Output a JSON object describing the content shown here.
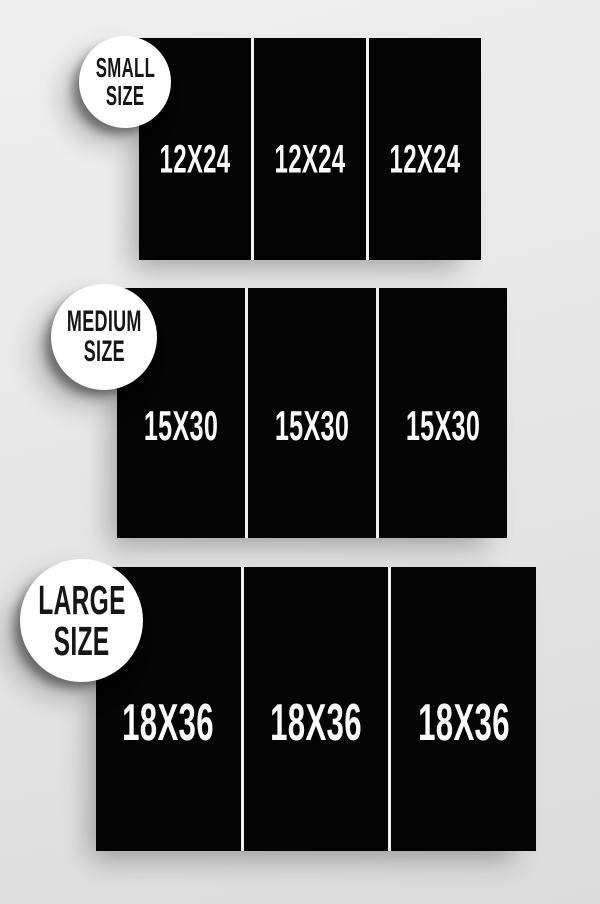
{
  "title": "Poster size chart",
  "colors": {
    "panel_bg": "#040404",
    "panel_text": "#fbfbfb",
    "divider": "#f2f2f2",
    "badge_bg": "#ffffff",
    "badge_text": "#161616",
    "page_bg_top": "#efefef",
    "page_bg_bottom": "#dbdbdb"
  },
  "groups": [
    {
      "id": "small",
      "badge": {
        "line1": "SMALL",
        "line2": "SIZE"
      },
      "panels": [
        "12X24",
        "12X24",
        "12X24"
      ]
    },
    {
      "id": "medium",
      "badge": {
        "line1": "MEDIUM",
        "line2": "SIZE"
      },
      "panels": [
        "15X30",
        "15X30",
        "15X30"
      ]
    },
    {
      "id": "large",
      "badge": {
        "line1": "LARGE",
        "line2": "SIZE"
      },
      "panels": [
        "18X36",
        "18X36",
        "18X36"
      ]
    }
  ]
}
